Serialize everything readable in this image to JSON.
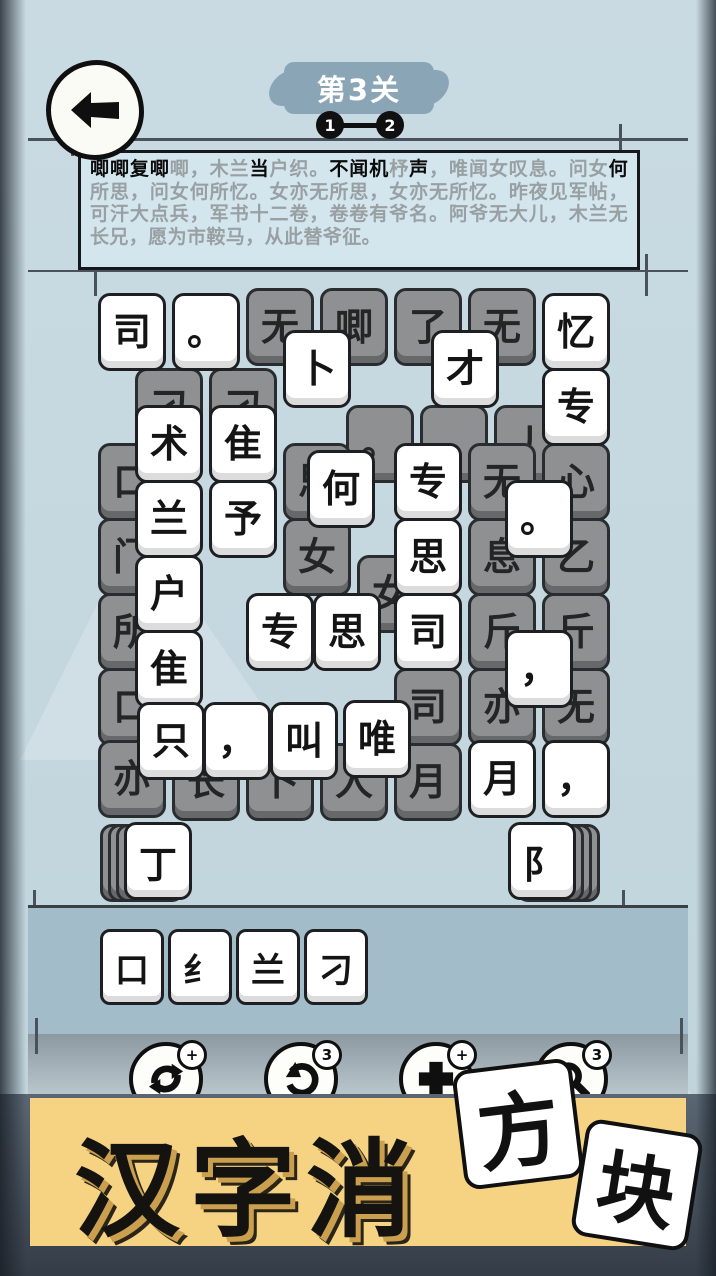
{
  "header": {
    "back_icon": "left-arrow",
    "level_label": "第3关",
    "progress_steps": [
      "1",
      "2"
    ]
  },
  "poem": {
    "segments": [
      {
        "text": "唧唧复唧",
        "state": "filled"
      },
      {
        "text": "唧，木兰",
        "state": "empty"
      },
      {
        "text": "当",
        "state": "filled"
      },
      {
        "text": "户织。",
        "state": "empty"
      },
      {
        "text": "不闻机",
        "state": "filled"
      },
      {
        "text": "杼",
        "state": "empty"
      },
      {
        "text": "声",
        "state": "filled"
      },
      {
        "text": "，唯闻女叹息。问女",
        "state": "empty"
      },
      {
        "text": "何",
        "state": "filled"
      },
      {
        "text": "所思，问女何所忆。女亦无所思，女亦无所忆。昨夜见军帖，可汗大点兵，军书十二卷，卷卷有爷名。阿爷无大儿，木兰无长兄，愿为市鞍马，从此替爷征。",
        "state": "empty"
      }
    ]
  },
  "board": {
    "tiles": [
      {
        "x": 98,
        "y": 293,
        "char": "司",
        "state": "active"
      },
      {
        "x": 172,
        "y": 293,
        "char": "。",
        "state": "active"
      },
      {
        "x": 246,
        "y": 288,
        "char": "无",
        "state": "blocked"
      },
      {
        "x": 320,
        "y": 288,
        "char": "唧",
        "state": "blocked"
      },
      {
        "x": 394,
        "y": 288,
        "char": "了",
        "state": "blocked"
      },
      {
        "x": 468,
        "y": 288,
        "char": "无",
        "state": "blocked"
      },
      {
        "x": 542,
        "y": 293,
        "char": "忆",
        "state": "active"
      },
      {
        "x": 135,
        "y": 368,
        "char": "刁",
        "state": "blocked"
      },
      {
        "x": 209,
        "y": 368,
        "char": "刁",
        "state": "blocked"
      },
      {
        "x": 283,
        "y": 330,
        "char": "卜",
        "state": "active"
      },
      {
        "x": 431,
        "y": 330,
        "char": "才",
        "state": "active"
      },
      {
        "x": 542,
        "y": 368,
        "char": "专",
        "state": "active"
      },
      {
        "x": 346,
        "y": 405,
        "char": "。",
        "state": "blocked"
      },
      {
        "x": 420,
        "y": 405,
        "char": "，",
        "state": "blocked"
      },
      {
        "x": 494,
        "y": 405,
        "char": "丿",
        "state": "blocked"
      },
      {
        "x": 135,
        "y": 405,
        "char": "术",
        "state": "active"
      },
      {
        "x": 209,
        "y": 405,
        "char": "隹",
        "state": "active"
      },
      {
        "x": 98,
        "y": 443,
        "char": "口",
        "state": "blocked"
      },
      {
        "x": 283,
        "y": 443,
        "char": "思",
        "state": "blocked"
      },
      {
        "x": 468,
        "y": 443,
        "char": "无",
        "state": "blocked"
      },
      {
        "x": 542,
        "y": 443,
        "char": "心",
        "state": "blocked"
      },
      {
        "x": 307,
        "y": 450,
        "char": "何",
        "state": "active"
      },
      {
        "x": 394,
        "y": 443,
        "char": "专",
        "state": "active"
      },
      {
        "x": 135,
        "y": 480,
        "char": "兰",
        "state": "active"
      },
      {
        "x": 209,
        "y": 480,
        "char": "予",
        "state": "active"
      },
      {
        "x": 505,
        "y": 480,
        "char": "。",
        "state": "active"
      },
      {
        "x": 98,
        "y": 518,
        "char": "门",
        "state": "blocked"
      },
      {
        "x": 283,
        "y": 518,
        "char": "女",
        "state": "blocked"
      },
      {
        "x": 468,
        "y": 518,
        "char": "息",
        "state": "blocked"
      },
      {
        "x": 542,
        "y": 518,
        "char": "乙",
        "state": "blocked"
      },
      {
        "x": 394,
        "y": 518,
        "char": "思",
        "state": "active"
      },
      {
        "x": 357,
        "y": 555,
        "char": "女",
        "state": "blocked"
      },
      {
        "x": 135,
        "y": 555,
        "char": "户",
        "state": "active"
      },
      {
        "x": 98,
        "y": 593,
        "char": "所",
        "state": "blocked"
      },
      {
        "x": 246,
        "y": 593,
        "char": "专",
        "state": "active"
      },
      {
        "x": 313,
        "y": 593,
        "char": "思",
        "state": "active"
      },
      {
        "x": 394,
        "y": 593,
        "char": "司",
        "state": "active"
      },
      {
        "x": 468,
        "y": 593,
        "char": "斤",
        "state": "blocked"
      },
      {
        "x": 542,
        "y": 593,
        "char": "斤",
        "state": "blocked"
      },
      {
        "x": 135,
        "y": 630,
        "char": "隹",
        "state": "active"
      },
      {
        "x": 505,
        "y": 630,
        "char": "，",
        "state": "active"
      },
      {
        "x": 98,
        "y": 668,
        "char": "口",
        "state": "blocked"
      },
      {
        "x": 394,
        "y": 668,
        "char": "司",
        "state": "blocked"
      },
      {
        "x": 468,
        "y": 668,
        "char": "亦",
        "state": "blocked"
      },
      {
        "x": 542,
        "y": 668,
        "char": "无",
        "state": "blocked"
      },
      {
        "x": 98,
        "y": 740,
        "char": "亦",
        "state": "blocked"
      },
      {
        "x": 137,
        "y": 702,
        "char": "只",
        "state": "active"
      },
      {
        "x": 203,
        "y": 702,
        "char": "，",
        "state": "active"
      },
      {
        "x": 270,
        "y": 702,
        "char": "叫",
        "state": "active"
      },
      {
        "x": 343,
        "y": 700,
        "char": "唯",
        "state": "active"
      },
      {
        "x": 172,
        "y": 743,
        "char": "长",
        "state": "blocked"
      },
      {
        "x": 246,
        "y": 743,
        "char": "卜",
        "state": "blocked"
      },
      {
        "x": 320,
        "y": 743,
        "char": "人",
        "state": "blocked"
      },
      {
        "x": 394,
        "y": 743,
        "char": "月",
        "state": "blocked"
      },
      {
        "x": 468,
        "y": 740,
        "char": "月",
        "state": "active"
      },
      {
        "x": 542,
        "y": 740,
        "char": "，",
        "state": "active"
      }
    ]
  },
  "stacks": {
    "left": {
      "char": "丁",
      "layers": 3
    },
    "right": {
      "char": "阝",
      "layers": 3
    }
  },
  "tray": {
    "tiles": [
      "口",
      "纟",
      "兰",
      "刁"
    ]
  },
  "toolbar": {
    "buttons": [
      {
        "id": "shuffle",
        "badge": "+"
      },
      {
        "id": "undo",
        "badge": "3"
      },
      {
        "id": "add-tile",
        "badge": "+"
      },
      {
        "id": "magnify",
        "badge": "3"
      }
    ]
  },
  "banner": {
    "title": "汉字消",
    "tiles": [
      "方",
      "块"
    ]
  },
  "colors": {
    "page_bg": "#c4d7df",
    "poem_box_bg": "#d4e6ed",
    "tray_band": "#a2bcc9",
    "tile_white": "#ffffff",
    "tile_gray": "#8f9092",
    "banner_yellow": "#f6d383",
    "level_badge": "#8aa6b6",
    "bottom_dark": "#3c4650"
  }
}
